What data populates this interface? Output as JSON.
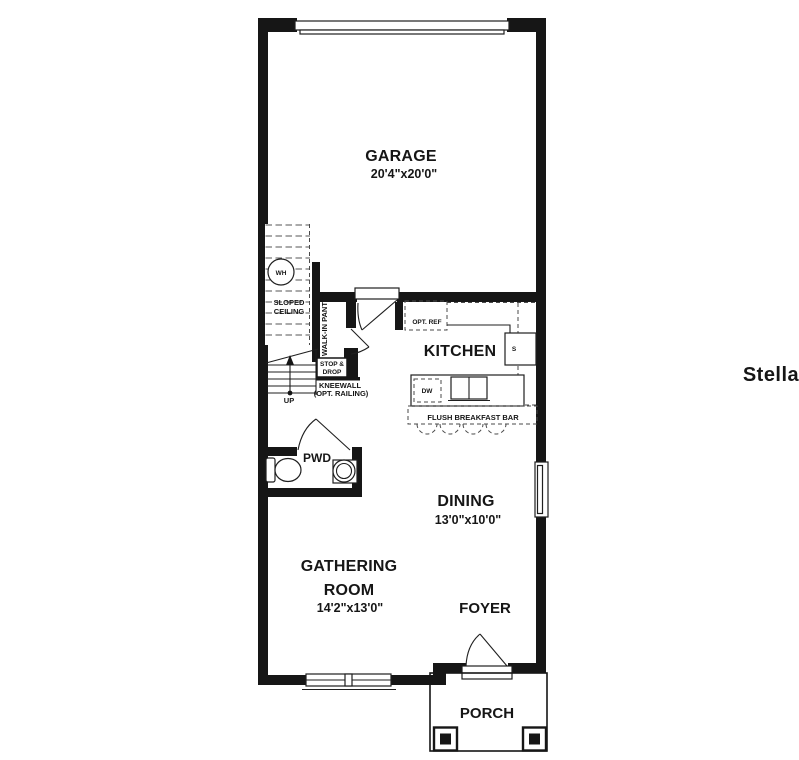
{
  "watermark": "StellarMLS",
  "rooms": {
    "garage": {
      "name": "GARAGE",
      "dims": "20'4\"x20'0\""
    },
    "kitchen": {
      "name": "KITCHEN"
    },
    "dining": {
      "name": "DINING",
      "dims": "13'0\"x10'0\""
    },
    "gathering": {
      "name_line1": "GATHERING",
      "name_line2": "ROOM",
      "dims": "14'2\"x13'0\""
    },
    "foyer": {
      "name": "FOYER"
    },
    "porch": {
      "name": "PORCH"
    },
    "pwd": {
      "name": "PWD"
    }
  },
  "labels": {
    "wh": "WH",
    "sloped_line1": "SLOPED",
    "sloped_line2": "CEILING",
    "pantry": "WALK-IN PANTRY",
    "stop_drop_line1": "STOP &",
    "stop_drop_line2": "DROP",
    "kneewall_line1": "KNEEWALL",
    "kneewall_line2": "(OPT. RAILING)",
    "up": "UP",
    "opt_ref": "OPT. REF",
    "dw": "DW",
    "s": "S",
    "breakfast_bar": "FLUSH BREAKFAST BAR"
  },
  "colors": {
    "wall": "#161616",
    "watermark": "#e7e7e9"
  }
}
